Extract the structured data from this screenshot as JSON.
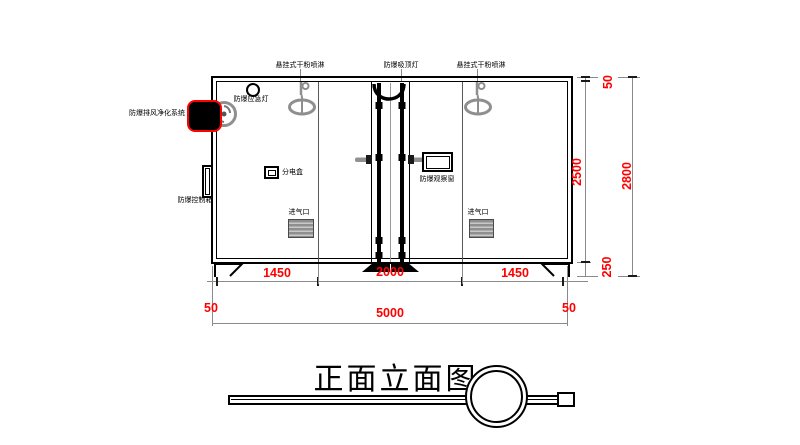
{
  "drawing": {
    "title": "正面立面图"
  },
  "labels": {
    "sprinkler_left": "悬挂式干粉喷淋",
    "ceiling_light": "防爆吸顶灯",
    "sprinkler_right": "悬挂式干粉喷淋",
    "emergency_light": "防爆应急灯",
    "exhaust_purification_system": "防爆排风净化系统",
    "control_box": "防爆控制箱",
    "distribution_box": "分电盒",
    "observation_window": "防爆观察窗",
    "air_inlet_left": "进气口",
    "air_inlet_right": "进气口"
  },
  "dimensions": {
    "segment_left": "1450",
    "segment_middle": "2000",
    "segment_right": "1450",
    "offset_left": "50",
    "total_width": "5000",
    "offset_right": "50",
    "roof_thickness": "50",
    "interior_height": "2500",
    "total_height": "2800",
    "base_height": "250"
  },
  "colors": {
    "dimension_text": "#ff0000",
    "highlight_outline": "#ff0000",
    "drawing_line": "#000000",
    "auxiliary_line": "#8a8a8a"
  }
}
